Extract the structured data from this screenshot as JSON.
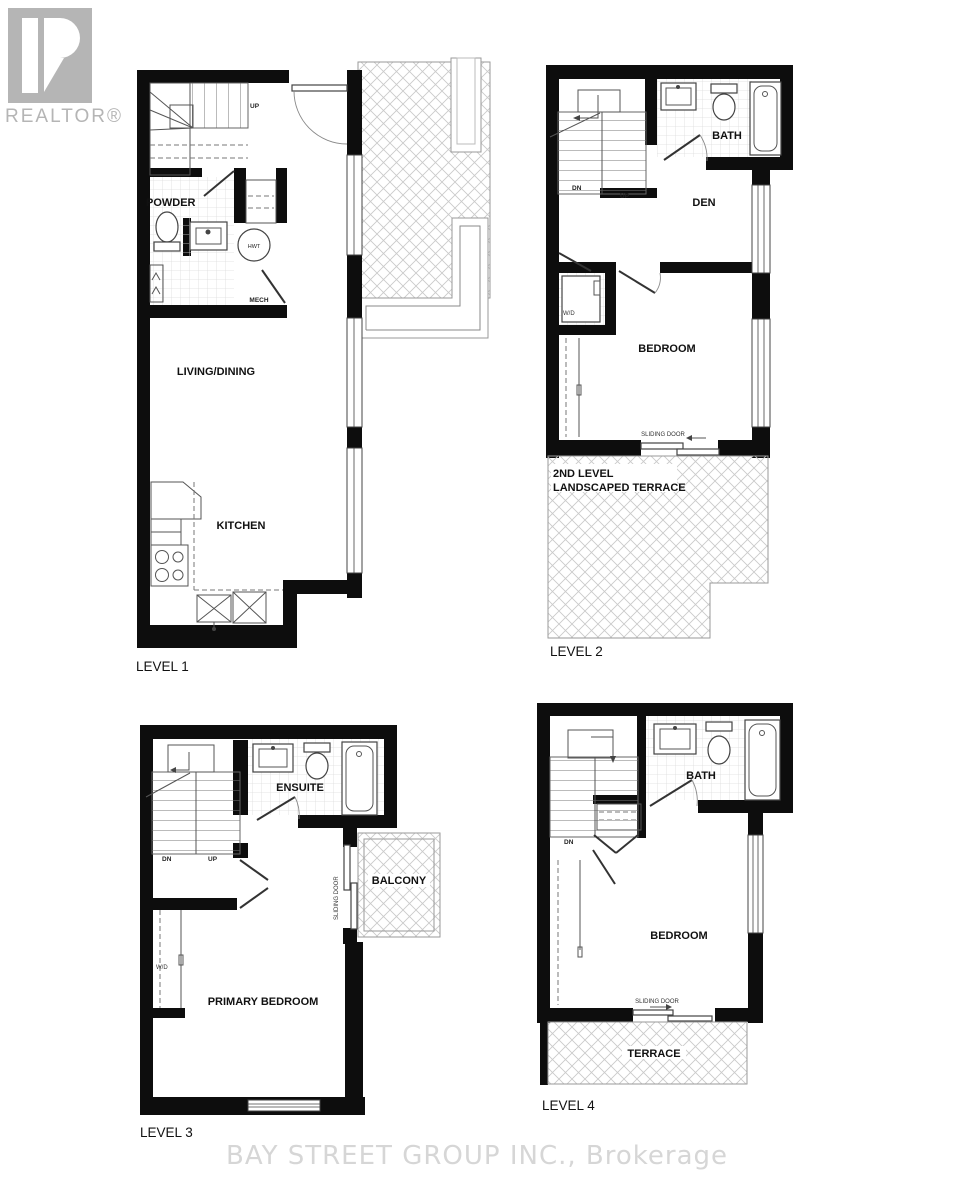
{
  "branding": {
    "logo_text": "REALTOR®"
  },
  "watermark": {
    "text": "BAY STREET GROUP INC., Brokerage"
  },
  "level1": {
    "title": "LEVEL 1",
    "entry": "ENTRY",
    "powder": "POWDER",
    "living_dining": "LIVING/DINING",
    "kitchen": "KITCHEN",
    "up": "UP",
    "hwt": "HWT",
    "mech": "MECH"
  },
  "level2": {
    "title": "LEVEL 2",
    "bath": "BATH",
    "den": "DEN",
    "bedroom": "BEDROOM",
    "wd": "W/D",
    "dn": "DN",
    "up": "UP",
    "sliding_door": "SLIDING DOOR",
    "terrace_line1": "2ND LEVEL",
    "terrace_line2": "LANDSCAPED TERRACE"
  },
  "level3": {
    "title": "LEVEL 3",
    "ensuite": "ENSUITE",
    "balcony": "BALCONY",
    "primary_bedroom": "PRIMARY BEDROOM",
    "wd": "W/D",
    "dn": "DN",
    "up": "UP",
    "sliding_door": "SLIDING DOOR"
  },
  "level4": {
    "title": "LEVEL 4",
    "bath": "BATH",
    "bedroom": "BEDROOM",
    "terrace": "TERRACE",
    "dn": "DN",
    "sliding_door": "SLIDING DOOR"
  },
  "colors": {
    "wall": "#0d0d0d",
    "hatch_line": "#cacaca",
    "logo_gray": "#b5b5b5",
    "watermark_gray": "#d6d6d6"
  }
}
